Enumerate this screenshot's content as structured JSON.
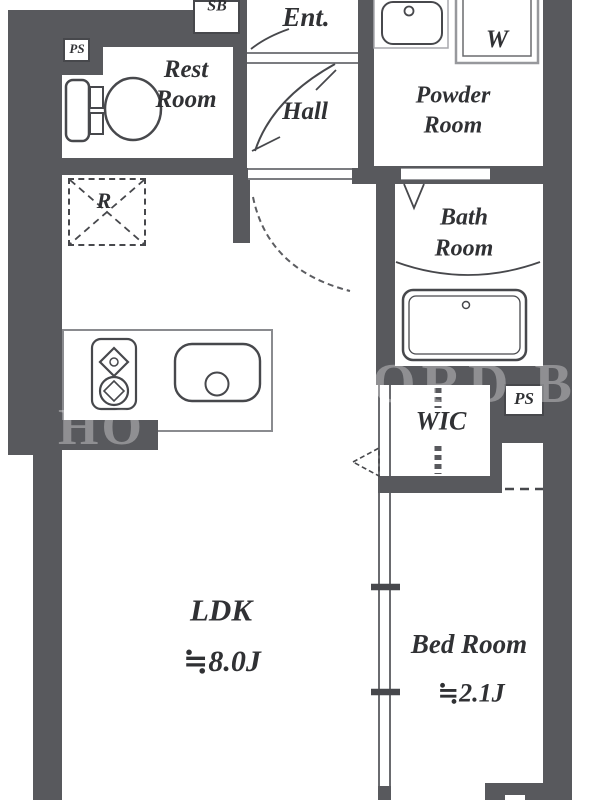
{
  "title": "apartment-floor-plan",
  "colors": {
    "wall": "#58595d",
    "fixture_line": "#47484c",
    "light_line": "#8a8b8f",
    "text": "#303134",
    "background": "#ffffff"
  },
  "rooms": {
    "entrance": "Ent.",
    "hall": "Hall",
    "rest_room": [
      "Rest",
      "Room"
    ],
    "powder_room": [
      "Powder",
      "Room"
    ],
    "bath_room": [
      "Bath",
      "Room"
    ],
    "wic": "WIC",
    "ldk": "LDK",
    "ldk_size": "≒8.0J",
    "bed_room": "Bed Room",
    "bed_room_size": "≒2.1J"
  },
  "labels": {
    "shoe_box": "SB",
    "washer": "W",
    "refrigerator": "R",
    "pipe_space_top": "PS",
    "pipe_space_mid": "PS"
  },
  "watermark": [
    "HO",
    "ORD B"
  ]
}
